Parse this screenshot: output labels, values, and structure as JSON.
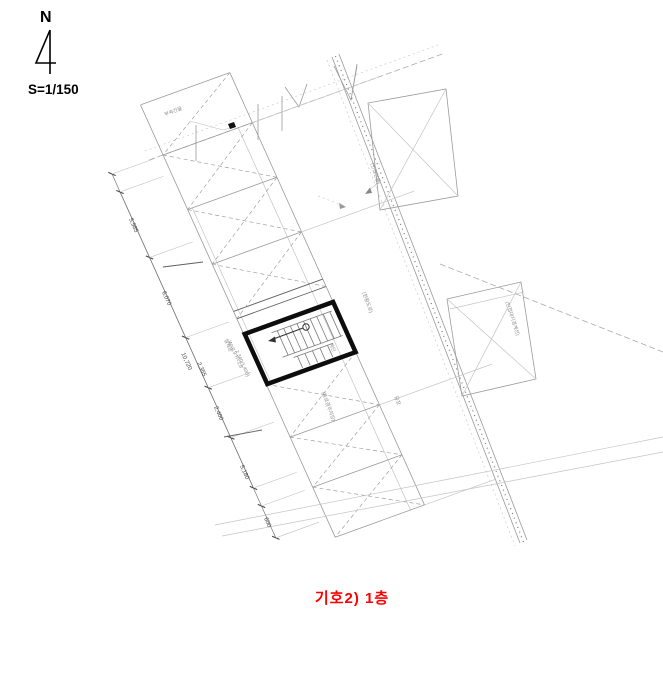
{
  "compass": {
    "label": "N"
  },
  "scale": {
    "label": "S=1/150"
  },
  "caption": {
    "label": "기호2) 1층",
    "color": "#ff0000"
  },
  "dimensions": {
    "d1": "5,985",
    "d2": "6,070",
    "d3": "10,720",
    "d4": "2,355",
    "d5": "2,400",
    "d6": "5,180",
    "d7": "600"
  },
  "annotations": {
    "a1": "부속건물",
    "a2": "(인접건물)",
    "a3": "(현황도로)",
    "a4": "(통로겸주차장)",
    "a5": "철제문",
    "a6": "W=0.9 H=1.8",
    "a7": "2,340(1,400)",
    "a8": "계단",
    "a9": "(인접대지경계선)",
    "a10": "담장"
  }
}
